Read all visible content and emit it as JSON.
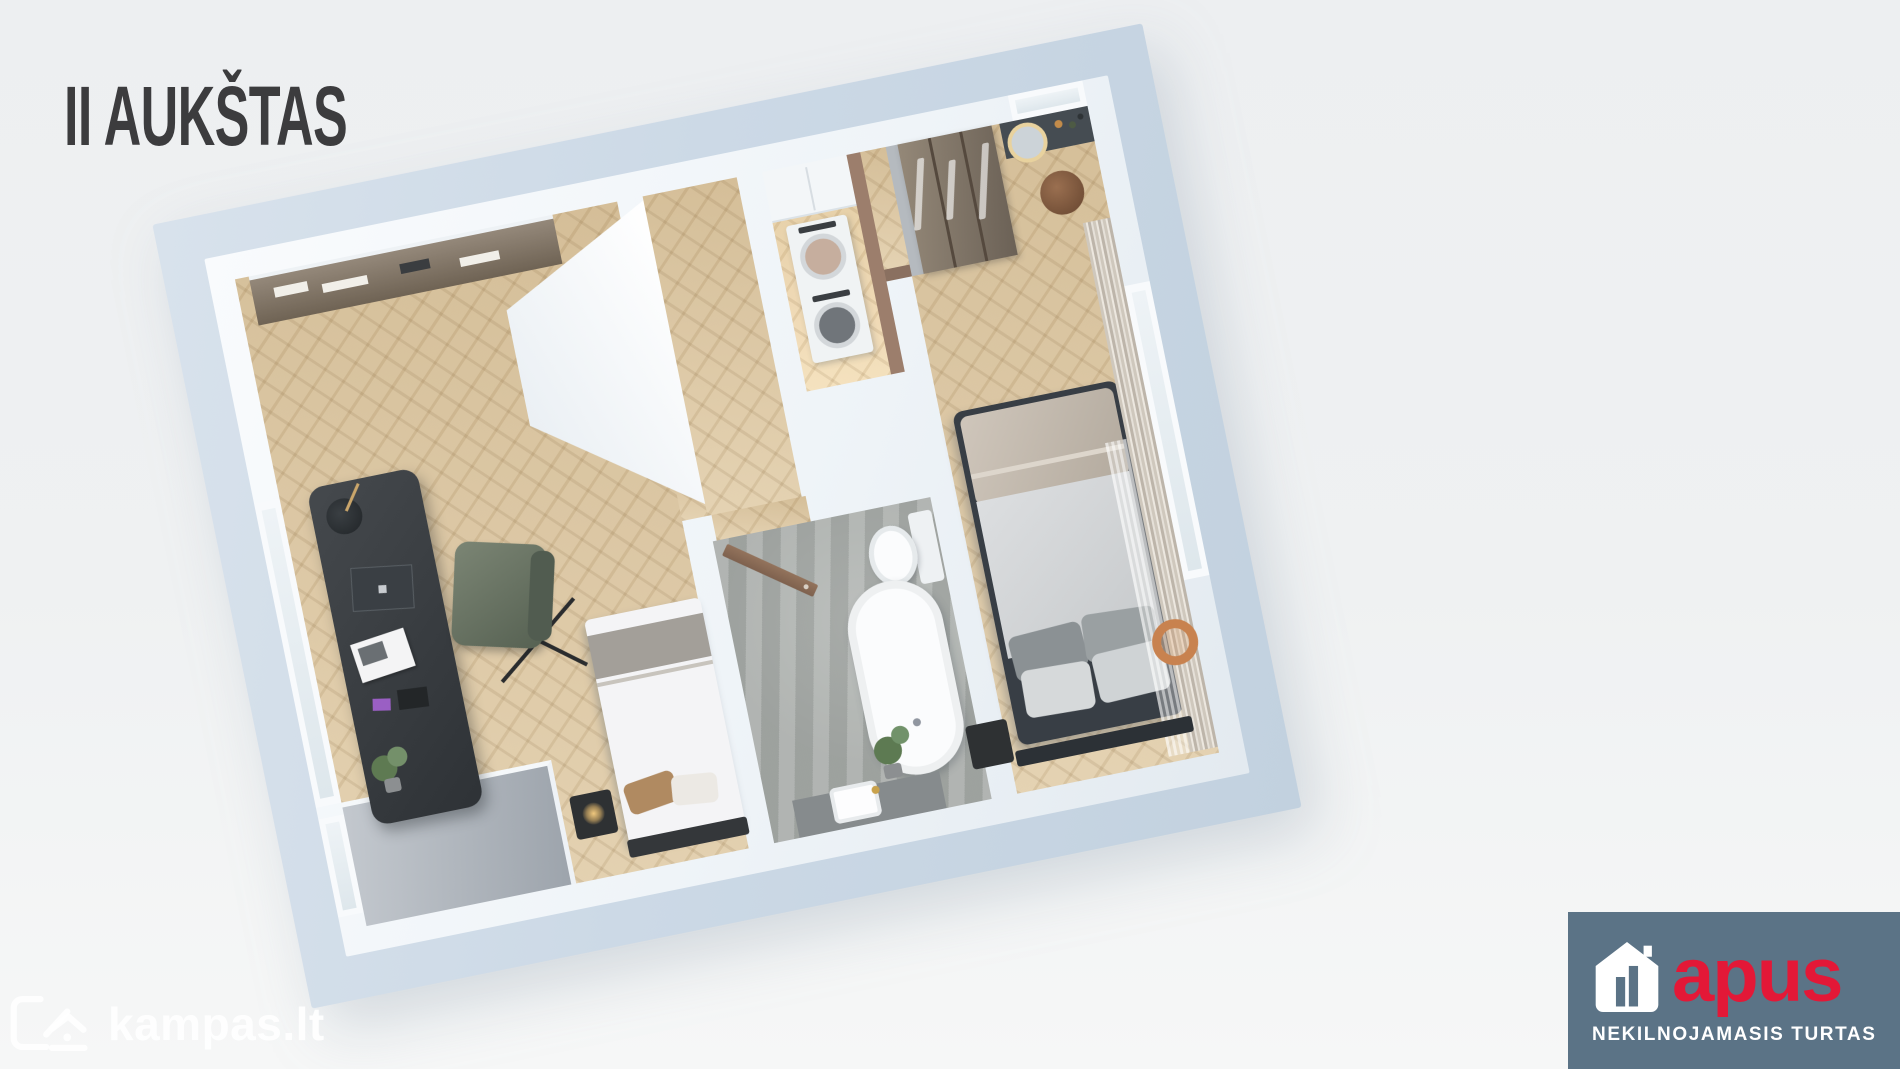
{
  "header": {
    "title": "II AUKŠTAS"
  },
  "watermark": {
    "text": "kampas.lt",
    "icon": "kampas-house-k-icon"
  },
  "brand": {
    "name": "apus",
    "tagline": "NEKILNOJAMASIS TURTAS",
    "icon": "house-icon",
    "colors": {
      "background": "#5b7386",
      "name": "#e31837",
      "tagline": "#ffffff"
    }
  },
  "palette": {
    "page_background": "#eff1f2",
    "slab_edge": "#ccd9e6",
    "walls": "#f3f6f9",
    "wood_floor": "#dcc6a2",
    "bathroom_floor": "#a8aca9",
    "dark_furniture": "#3c4043",
    "title_text": "#3c3c3e"
  }
}
